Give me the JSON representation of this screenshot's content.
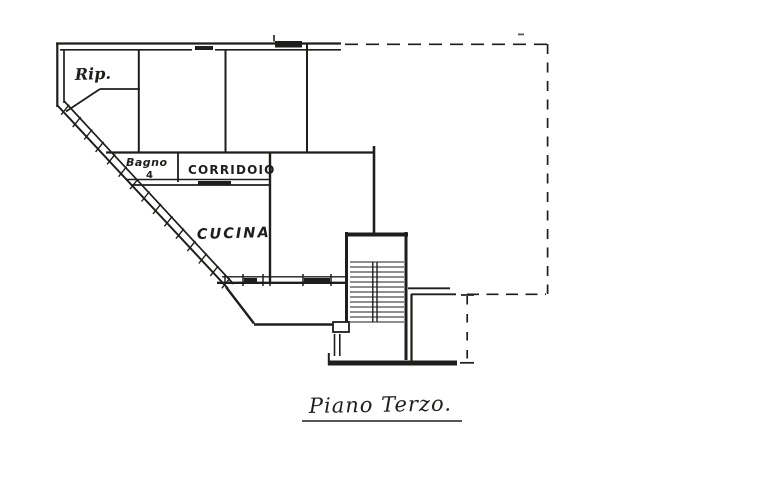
{
  "plan": {
    "title": {
      "text": "Piano Terzo.",
      "underlined": true
    },
    "rooms": [
      {
        "id": "ripostiglio",
        "label": "Rip."
      },
      {
        "id": "bagno",
        "label": "Bagno",
        "number": "4"
      },
      {
        "id": "corridoio",
        "label": "CORRIDOIO"
      },
      {
        "id": "cucina",
        "label": "CUCINA"
      }
    ],
    "colors": {
      "paper": "#ffffff",
      "ink": "#1e1e1c"
    },
    "features": {
      "staircase": "stairwell-with-treads",
      "boundary": "dashed-adjacent-unit-outline",
      "party_wall": "hatched-diagonal-wall"
    }
  }
}
